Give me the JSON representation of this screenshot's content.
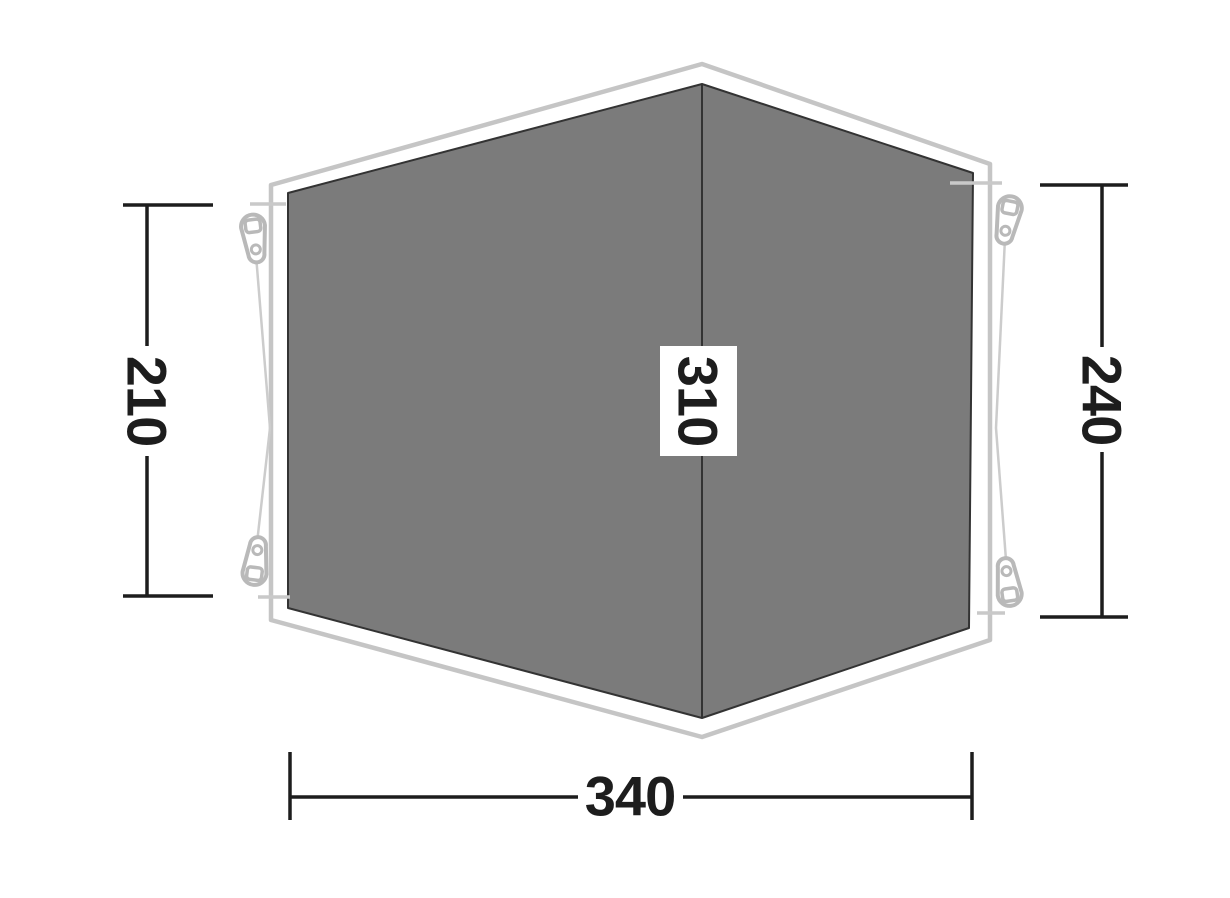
{
  "diagram": {
    "title": "Tent footprint dimension diagram",
    "dimensions": {
      "left": {
        "label": "210"
      },
      "ridge": {
        "label": "310"
      },
      "right": {
        "label": "240"
      },
      "bottom": {
        "label": "340"
      }
    },
    "colors": {
      "background": "#ffffff",
      "flysheet_outline": "#c5c5c5",
      "groundsheet_fill": "#7b7b7b",
      "groundsheet_edge": "#333333",
      "guyline": "#cccccc",
      "corner_tick": "#c9c9c9",
      "peg": "#b9b9b9",
      "dimension_line": "#1d1d1d",
      "dimension_text": "#1d1d1d",
      "label_background": "#ffffff"
    }
  }
}
